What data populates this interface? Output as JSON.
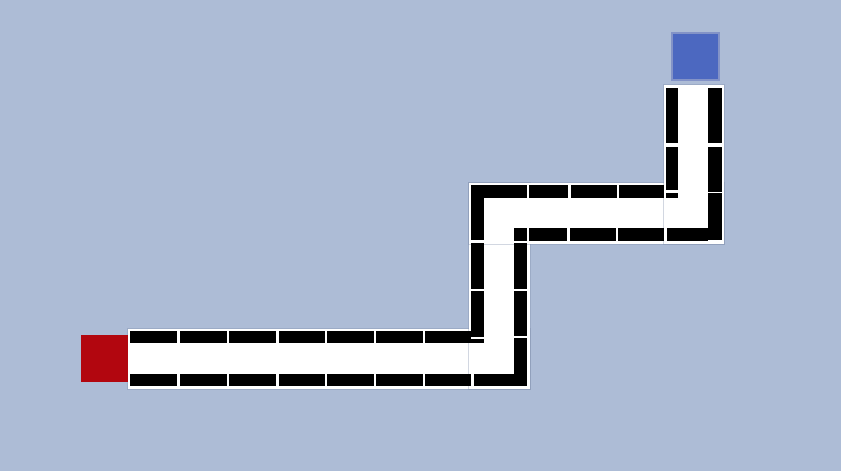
{
  "scene": {
    "type": "maze-path-puzzle",
    "canvas": {
      "width": 841,
      "height": 471,
      "background_color": "#adbcd6"
    },
    "palette": {
      "path_color": "#ffffff",
      "wall_color": "#000000",
      "start_color": "#b2060f",
      "goal_color": "#4c68c0",
      "goal_border_color": "#8393c7"
    },
    "start_square": {
      "x": 81,
      "y": 335,
      "width": 47,
      "height": 47
    },
    "goal_square": {
      "x": 671,
      "y": 32,
      "width": 49,
      "height": 49
    },
    "corridors": [
      {
        "id": "corridor-bottom-horizontal",
        "x": 127.5,
        "y": 328.5,
        "width": 402,
        "height": 60
      },
      {
        "id": "corridor-mid-vertical",
        "x": 468.5,
        "y": 182.5,
        "width": 61,
        "height": 206
      },
      {
        "id": "corridor-middle-horizontal",
        "x": 468.5,
        "y": 182.5,
        "width": 255,
        "height": 61
      },
      {
        "id": "corridor-top-vertical",
        "x": 663.5,
        "y": 85,
        "width": 60,
        "height": 158.5
      }
    ],
    "wall_segments": [
      [
        130,
        331,
        47,
        12.3
      ],
      [
        179.5,
        331,
        47.5,
        12.3
      ],
      [
        229,
        331,
        47,
        12.3
      ],
      [
        278.5,
        331,
        46,
        12.3
      ],
      [
        327,
        331,
        46.5,
        12.3
      ],
      [
        376,
        331,
        46.5,
        12.3
      ],
      [
        425,
        331,
        46.3,
        12.3
      ],
      [
        130,
        373.5,
        47,
        12.5
      ],
      [
        179.5,
        373.5,
        47.5,
        12.5
      ],
      [
        229,
        373.5,
        47,
        12.5
      ],
      [
        278.5,
        373.5,
        46,
        12.5
      ],
      [
        327,
        373.5,
        46.5,
        12.5
      ],
      [
        376,
        373.5,
        46.5,
        12.5
      ],
      [
        425,
        373.5,
        46.3,
        12.5
      ],
      [
        473.7,
        373.5,
        47,
        12.5
      ],
      [
        471,
        184.7,
        56,
        13
      ],
      [
        471,
        197.7,
        13,
        42.8
      ],
      [
        471,
        242.5,
        13,
        46
      ],
      [
        471,
        291,
        13,
        45.5
      ],
      [
        471,
        339,
        13,
        4.3
      ],
      [
        514.3,
        228,
        12.7,
        12.5
      ],
      [
        514.3,
        243,
        12.7,
        45.5
      ],
      [
        514.3,
        291.3,
        12.7,
        44.7
      ],
      [
        514.3,
        338,
        12.7,
        48
      ],
      [
        529.3,
        184.7,
        39,
        13
      ],
      [
        570.7,
        184.7,
        46,
        13
      ],
      [
        619.3,
        184.7,
        45,
        13
      ],
      [
        529,
        228,
        38.3,
        12.5
      ],
      [
        570,
        228,
        46,
        12.5
      ],
      [
        618.3,
        228,
        46,
        12.5
      ],
      [
        666.7,
        228,
        41.6,
        12.5
      ],
      [
        666,
        88.3,
        12.3,
        55
      ],
      [
        666,
        146.7,
        12.3,
        43.3
      ],
      [
        666,
        193.3,
        12.3,
        4.4
      ],
      [
        708.3,
        88.3,
        13.4,
        55
      ],
      [
        708.3,
        146.7,
        13.4,
        45
      ],
      [
        708.3,
        193.3,
        13.4,
        47.2
      ]
    ]
  }
}
